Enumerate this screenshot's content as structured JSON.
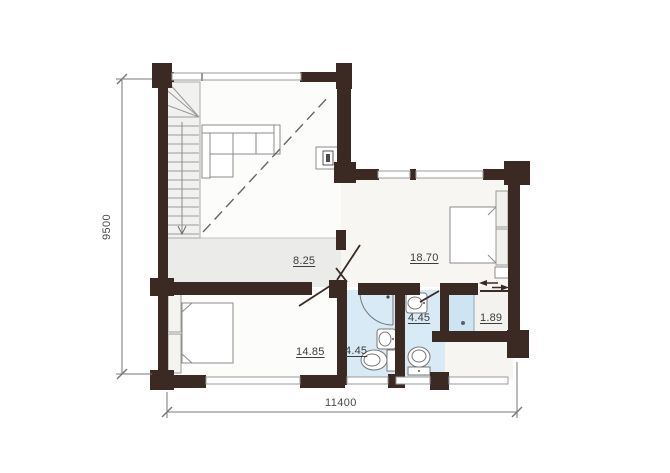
{
  "plan": {
    "kind": "floor-plan",
    "rooms": [
      {
        "id": "hall",
        "area": "8.25"
      },
      {
        "id": "bedroom-main",
        "area": "18.70"
      },
      {
        "id": "bedroom-second",
        "area": "14.85"
      },
      {
        "id": "bathroom-shower",
        "area": "4.45"
      },
      {
        "id": "bathroom-wc",
        "area": "4.45"
      },
      {
        "id": "entry",
        "area": "1.89"
      }
    ],
    "dimensions": {
      "overall_width_mm": "11400",
      "overall_depth_mm": "9500"
    },
    "colors": {
      "wall": "#3a2a23",
      "bathroom_floor": "#d8eaf5",
      "hall_floor": "#ebebe9",
      "bedroom_floor": "#f7f6f3",
      "background": "#ffffff",
      "furniture_stroke": "#8b8b8b",
      "dimension_line": "#777777"
    },
    "furniture": [
      "staircase",
      "corner-sofa",
      "fireplace",
      "double-bed",
      "double-bed-2",
      "corner-shower",
      "washbasin",
      "washbasin-2",
      "toilet",
      "toilet-2",
      "shower-cabin",
      "sliding-door",
      "wardrobe"
    ]
  }
}
